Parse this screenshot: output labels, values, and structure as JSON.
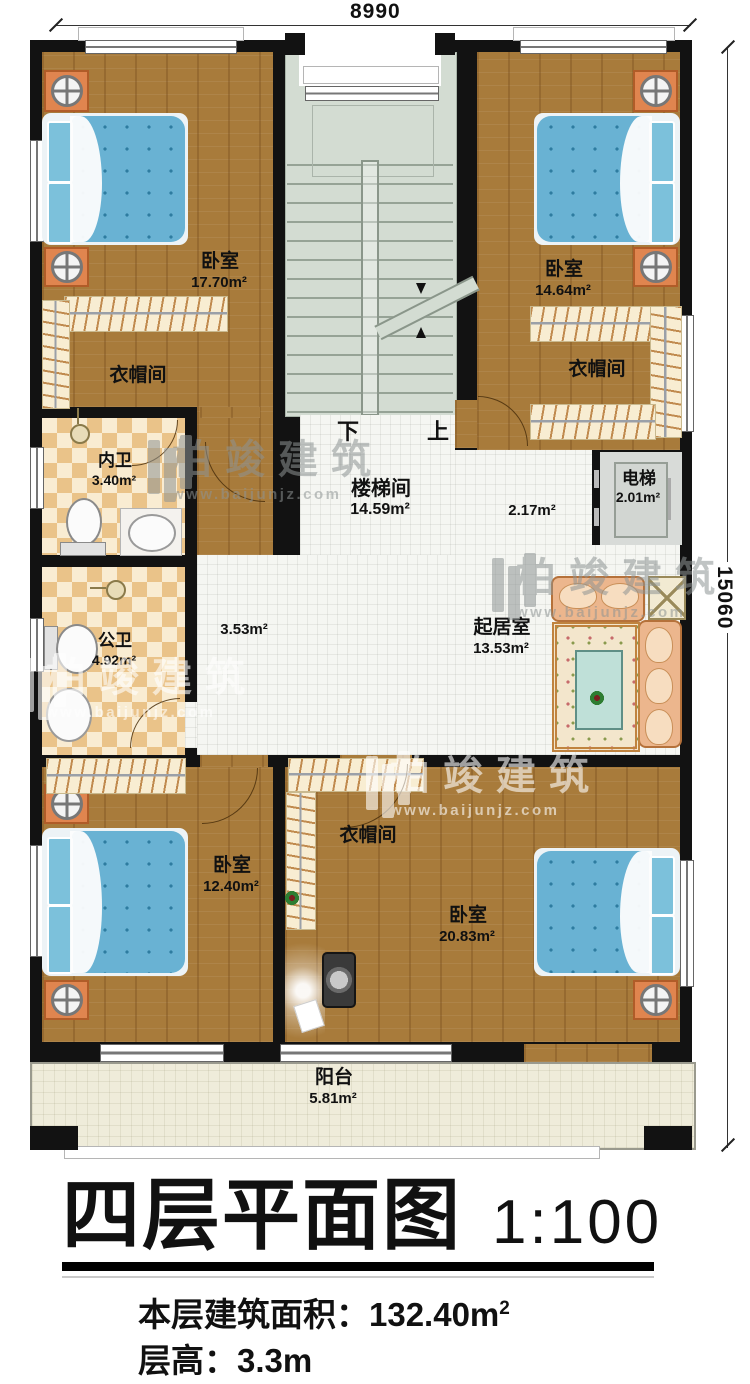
{
  "plan": {
    "dimensions": {
      "top": "8990",
      "right": "15060"
    },
    "stairs": {
      "down": "下",
      "up": "上"
    },
    "rooms": {
      "bedroom_tl": {
        "label": "卧室",
        "area": "17.70m²"
      },
      "cloak_tl": {
        "label": "衣帽间"
      },
      "bedroom_tr": {
        "label": "卧室",
        "area": "14.64m²"
      },
      "cloak_tr": {
        "label": "衣帽间"
      },
      "bath_inner": {
        "label": "内卫",
        "area": "3.40m²"
      },
      "bath_public": {
        "label": "公卫",
        "area": "4.92m²"
      },
      "stairwell": {
        "label": "楼梯间",
        "area": "14.59m²"
      },
      "hall": {
        "area_left": "3.53m²",
        "area_right": "2.17m²"
      },
      "elevator": {
        "label": "电梯",
        "area": "2.01m²"
      },
      "living": {
        "label": "起居室",
        "area": "13.53m²"
      },
      "bedroom_bl": {
        "label": "卧室",
        "area": "12.40m²"
      },
      "cloak_b": {
        "label": "衣帽间"
      },
      "bedroom_br": {
        "label": "卧室",
        "area": "20.83m²"
      },
      "balcony": {
        "label": "阳台",
        "area": "5.81m²"
      }
    }
  },
  "watermark": {
    "brand": "柏竣建筑",
    "site": "www.baijunjz.com"
  },
  "titleblock": {
    "title": "四层平面图",
    "scale": "1:100",
    "building_area_label": "本层建筑面积：",
    "building_area_value": "132.40m",
    "building_area_sup": "2",
    "floor_height": "层高：3.3m"
  },
  "colors": {
    "wall": "#121212",
    "wood_floor": "#a87b3b",
    "hall_tile": "#f5f6f2",
    "bath_checker": "#eac389",
    "stair_floor": "#d3dcd2",
    "balcony_floor": "#efecda",
    "bed_blue": "#69b2d3",
    "nightstand_orange": "#e0854f",
    "sofa_tan": "#ecb68d",
    "watermark_gray": "#8e9494"
  }
}
